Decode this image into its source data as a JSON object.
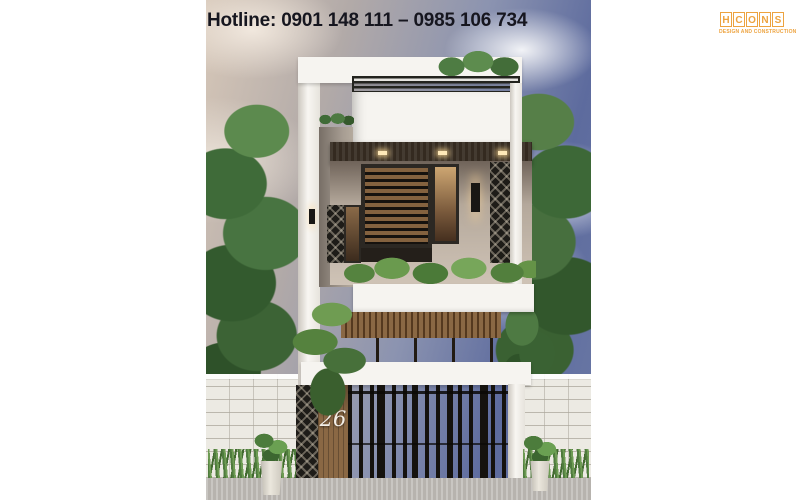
{
  "hotline": {
    "label": "Hotline: 0901 148 111 – 0985 106 734"
  },
  "logo": {
    "name": "HCONS",
    "letters": [
      "H",
      "C",
      "O",
      "N",
      "S"
    ],
    "subtitle": "DESIGN AND CONSTRUCTION"
  },
  "photo": {
    "house_number": "26"
  },
  "colors": {
    "accent_orange": "#eda33f",
    "hotline_text": "#16161f",
    "sky_blue": "#5d6b9e",
    "cloud_beige": "#d6c7b8",
    "foliage_green": "#3f6b39",
    "wood_brown": "#8a6844",
    "dark_panel": "#1e1c18",
    "wall_white": "#f6f4f0",
    "fence_white": "#eceae3",
    "pavement_gray": "#b7b3ae"
  }
}
